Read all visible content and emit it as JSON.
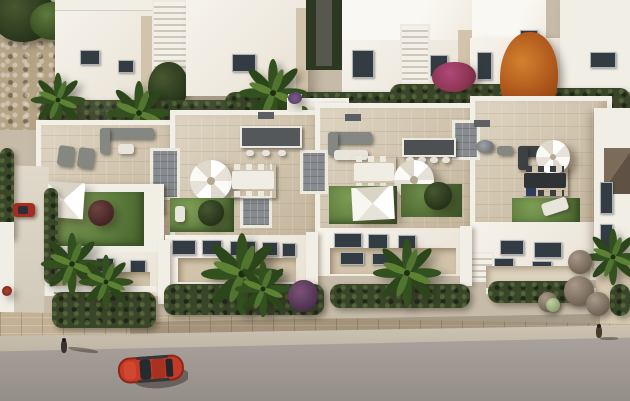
{
  "scene": {
    "alt": "Aerial 3D architectural rendering of a white modern townhouse complex with beige-tiled rooftop terraces, outdoor furniture, white parasols and shade sails, green rooftop lawns, palm trees and dark hedges, a travertine boundary wall and sidewalk, a grey street with a red car and two pedestrians, surrounding white buildings, an orange autumn tree and purple bougainvillea",
    "palette": {
      "building_white": "#f1eee6",
      "building_shadow_wall": "#d2c4aa",
      "terrace_floor_beige": "#d3c6ae",
      "rooftop_lawn_green": "#5b7a3c",
      "hedge_dark_green": "#39462a",
      "street_gray": "#a39c96",
      "sidewalk_tan": "#c3bAA9",
      "stone_wall_travertine": "#c2b195",
      "car_red": "#b9321f",
      "window_dark": "#333c43",
      "autumn_tree_orange": "#a64f17",
      "bougainvillea_purple": "#5d3a57",
      "bougainvillea_magenta": "#8d3553",
      "stair_tile_gray": "#878b8f"
    },
    "inventory": [
      "background-buildings",
      "stone-patio",
      "garden-corridor",
      "cypress-hedge-row",
      "orange-autumn-tree",
      "purple-tree",
      "magenta-bougainvillea",
      "rooftop-terrace-1",
      "rooftop-terrace-2",
      "rooftop-terrace-3",
      "rooftop-terrace-4",
      "shade-sail",
      "white-parasol",
      "outdoor-sofa",
      "dining-set",
      "kitchen-island",
      "rooftop-lawn",
      "sun-lounger",
      "stair-bulkhead",
      "satellite-dish",
      "front-facade-windows",
      "recessed-balcony",
      "palm-trees",
      "front-hedge",
      "stone-boundary-wall",
      "sidewalk",
      "street",
      "red-car",
      "parked-red-car",
      "walking-pedestrian",
      "standing-pedestrian",
      "driveway",
      "mauve-shrub-balls",
      "right-house-pitched-roof"
    ]
  }
}
